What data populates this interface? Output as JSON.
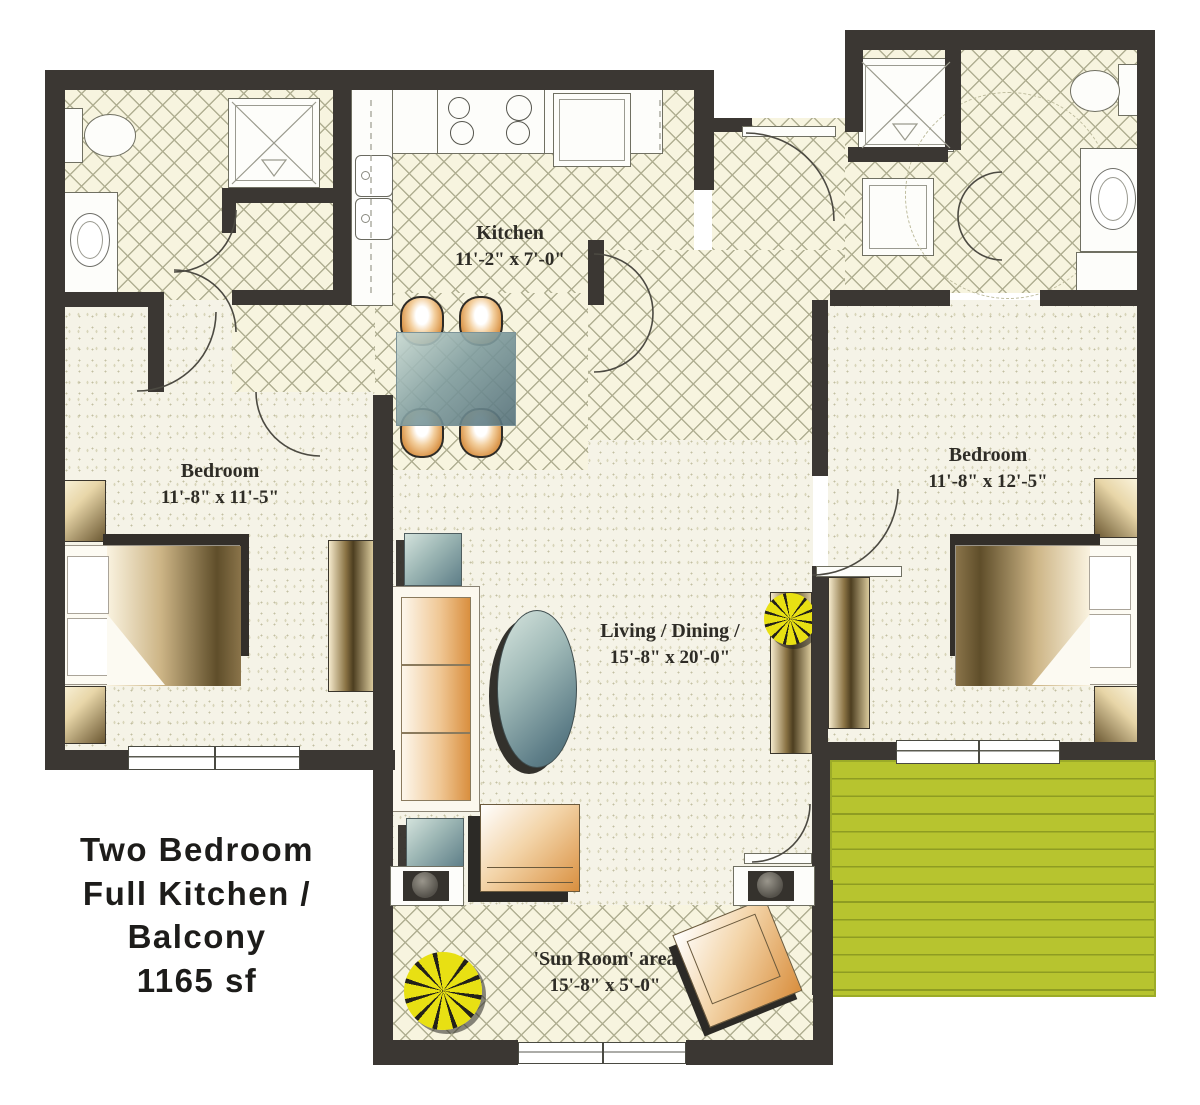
{
  "title": {
    "line1": "Two Bedroom",
    "line2": "Full Kitchen /",
    "line3": "Balcony",
    "line4": "1165 sf"
  },
  "rooms": {
    "kitchen": {
      "name": "Kitchen",
      "dims": "11'-2\" x 7'-0\""
    },
    "bedroom_left": {
      "name": "Bedroom",
      "dims": "11'-8\" x 11'-5\""
    },
    "bedroom_right": {
      "name": "Bedroom",
      "dims": "11'-8\" x 12'-5\""
    },
    "living_dining": {
      "name": "Living / Dining /",
      "dims": "15'-8\" x 20'-0\""
    },
    "sun_room": {
      "name": "'Sun Room' area",
      "dims": "15'-8\" x 5'-0\""
    }
  },
  "colors": {
    "wall": "#3b3733",
    "tile_floor": "#f7f4df",
    "tile_line": "#b0af92",
    "carpet": "#f5f3e7",
    "balcony_green": "#b7c42f",
    "furniture_tan": "#d98f3f",
    "table_blue": "#5e7e88",
    "plant_yellow": "#e8e013"
  }
}
